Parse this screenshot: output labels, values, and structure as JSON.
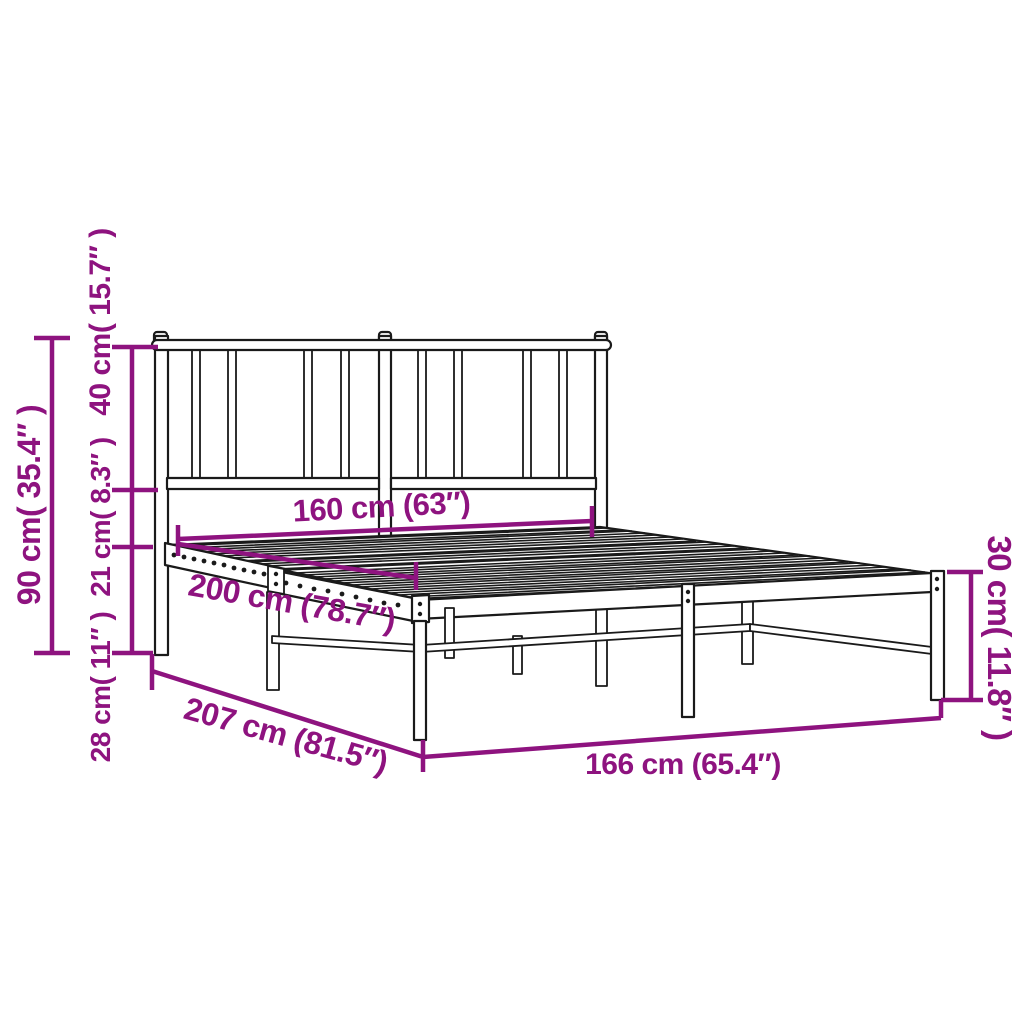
{
  "title": "Metal bed frame with headboard — dimension diagram",
  "colors": {
    "annotation": "#8E137F",
    "line_art": "#1a1a1a",
    "background": "#ffffff"
  },
  "dimensions": {
    "headboard_height": {
      "label": "90 cm( 35.4″ )"
    },
    "headboard_upper": {
      "label": "40 cm( 15.7″ )"
    },
    "frame_rail": {
      "label": "21 cm( 8.3″ )"
    },
    "underbed_clearance": {
      "label": "28 cm( 11″ )"
    },
    "mattress_width": {
      "label": "160 cm (63″)"
    },
    "mattress_length": {
      "label": "200 cm (78.7″)"
    },
    "overall_length": {
      "label": "207 cm (81.5″)"
    },
    "overall_width": {
      "label": "166 cm (65.4″)"
    },
    "platform_height": {
      "label": "30 cm( 11.8″ )"
    }
  }
}
